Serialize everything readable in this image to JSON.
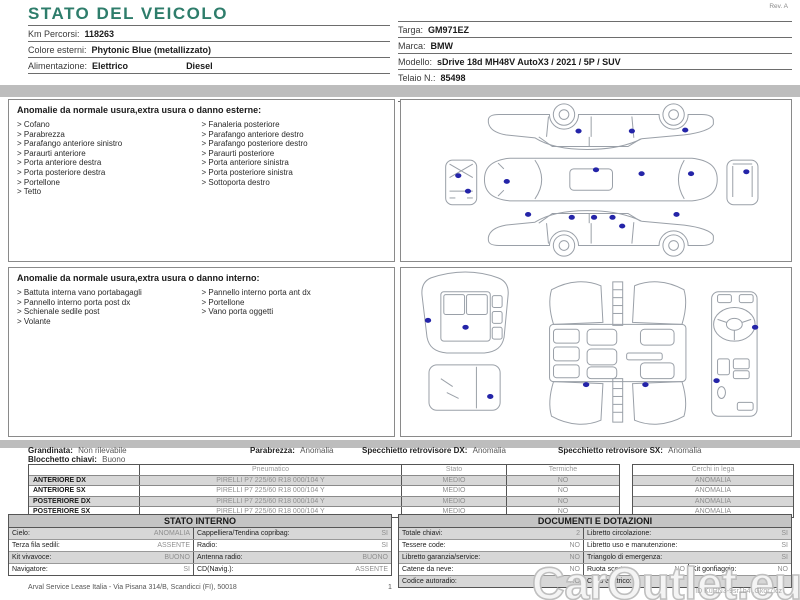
{
  "colors": {
    "accent_green": "#2e7d6b",
    "damage_dot_blue": "#2424a8",
    "bar_gray": "#bdbdbd",
    "row_shade_gray": "#d7d7d7",
    "muted_text_gray": "#8f8f8f"
  },
  "header": {
    "title": "STATO DEL VEICOLO",
    "rev": "Rev. A"
  },
  "vehicle_info_left": {
    "rows": [
      {
        "label": "Km Percorsi:",
        "value": "118263"
      },
      {
        "label": "Colore esterni:",
        "value": "Phytonic Blue (metallizzato)"
      },
      {
        "label": "Alimentazione:",
        "value": "Elettrico",
        "value2": "Diesel"
      }
    ]
  },
  "vehicle_info_right": {
    "rows": [
      {
        "label": "Targa:",
        "value": "GM971EZ"
      },
      {
        "label": "Marca:",
        "value": "BMW"
      },
      {
        "label": "Modello:",
        "value": "sDrive 18d MH48V AutoX3 / 2021 / 5P / SUV"
      },
      {
        "label": "Telaio N.:",
        "value": "85498"
      },
      {
        "label": "1a imm.:",
        "value": "29/11/2022"
      }
    ]
  },
  "exterior": {
    "title": "Anomalie da normale usura,extra usura o danno esterne:",
    "items_left": [
      "> Cofano",
      "> Parabrezza",
      "> Parafango anteriore sinistro",
      "> Paraurti anteriore",
      "> Porta anteriore destra",
      "> Porta posteriore destra",
      "> Portellone",
      "> Tetto"
    ],
    "items_right": [
      "> Fanaleria posteriore",
      "> Parafango anteriore destro",
      "> Parafango posteriore destro",
      "> Paraurti posteriore",
      "> Porta anteriore sinistra",
      "> Porta posteriore sinistra",
      "> Sottoporta destro"
    ],
    "damage_points": 16
  },
  "interior": {
    "title": "Anomalie da normale usura,extra usura o danno interno:",
    "items_left": [
      "> Battuta interna vano portabagagli",
      "> Pannello interno porta post dx",
      "> Schienale sedile post",
      "> Volante"
    ],
    "items_right": [
      "> Pannello interno porta ant dx",
      "> Portellone",
      "> Vano porta oggetti"
    ],
    "damage_points": 7
  },
  "summary": {
    "grandinata_label": "Grandinata:",
    "grandinata_value": "Non rilevabile",
    "parabrezza_label": "Parabrezza:",
    "parabrezza_value": "Anomalia",
    "specchietto_dx_label": "Specchietto retrovisore DX:",
    "specchietto_dx_value": "Anomalia",
    "specchietto_sx_label": "Specchietto retrovisore SX:",
    "specchietto_sx_value": "Anomalia",
    "blocchetto_label": "Blocchetto chiavi:",
    "blocchetto_value": "Buono"
  },
  "tires": {
    "headers": {
      "pneumatico": "Pneumatico",
      "stato": "Stato",
      "termiche": "Termiche",
      "cerchi": "Cerchi in lega"
    },
    "rows": [
      {
        "position": "ANTERIORE DX",
        "tire": "PIRELLI P7 225/60 R18 000/104 Y",
        "stato": "MEDIO",
        "termiche": "NO",
        "cerchi": "ANOMALIA"
      },
      {
        "position": "ANTERIORE SX",
        "tire": "PIRELLI P7 225/60 R18 000/104 Y",
        "stato": "MEDIO",
        "termiche": "NO",
        "cerchi": "ANOMALIA"
      },
      {
        "position": "POSTERIORE DX",
        "tire": "PIRELLI P7 225/60 R18 000/104 Y",
        "stato": "MEDIO",
        "termiche": "NO",
        "cerchi": "ANOMALIA"
      },
      {
        "position": "POSTERIORE SX",
        "tire": "PIRELLI P7 225/60 R18 000/104 Y",
        "stato": "MEDIO",
        "termiche": "NO",
        "cerchi": "ANOMALIA"
      }
    ]
  },
  "stato_interno": {
    "title": "STATO INTERNO",
    "rows": [
      {
        "l_label": "Cielo:",
        "l_value": "ANOMALIA",
        "r_label": "Cappelliera/Tendina copribag:",
        "r_value": "SI"
      },
      {
        "l_label": "Terza fila sedili:",
        "l_value": "ASSENTE",
        "r_label": "Radio:",
        "r_value": "SI"
      },
      {
        "l_label": "Kit vivavoce:",
        "l_value": "BUONO",
        "r_label": "Antenna radio:",
        "r_value": "BUONO"
      },
      {
        "l_label": "Navigatore:",
        "l_value": "SI",
        "r_label": "CD(Navig.):",
        "r_value": "ASSENTE"
      }
    ]
  },
  "documenti": {
    "title": "DOCUMENTI E DOTAZIONI",
    "rows": [
      {
        "l_label": "Totale chiavi:",
        "l_value": "2",
        "r_label": "Libretto circolazione:",
        "r_value": "SI"
      },
      {
        "l_label": "Tessere code:",
        "l_value": "NO",
        "r_label": "Libretto uso e manutenzione:",
        "r_value": "SI"
      },
      {
        "l_label": "Libretto garanzia/service:",
        "l_value": "NO",
        "r_label": "Triangolo di emergenza:",
        "r_value": "SI"
      },
      {
        "l_label": "Catene da neve:",
        "l_value": "NO",
        "r_label": "Ruota scorta:",
        "r_value": "NO",
        "r2_label": "Kit gonfiaggio:",
        "r2_value": "NO"
      },
      {
        "l_label": "Codice autoradio:",
        "l_value": "NO",
        "r_label": "Cavo elettrico:",
        "r_value": ""
      }
    ]
  },
  "footer": {
    "company": "Arval Service Lease Italia - Via Pisana 314/B, Scandicci (FI), 50018",
    "page": "1",
    "watermark": "CarOutlet.eu",
    "doc_id": "ID KuRN3-9sr1b4 ,Gkor7lcz"
  }
}
